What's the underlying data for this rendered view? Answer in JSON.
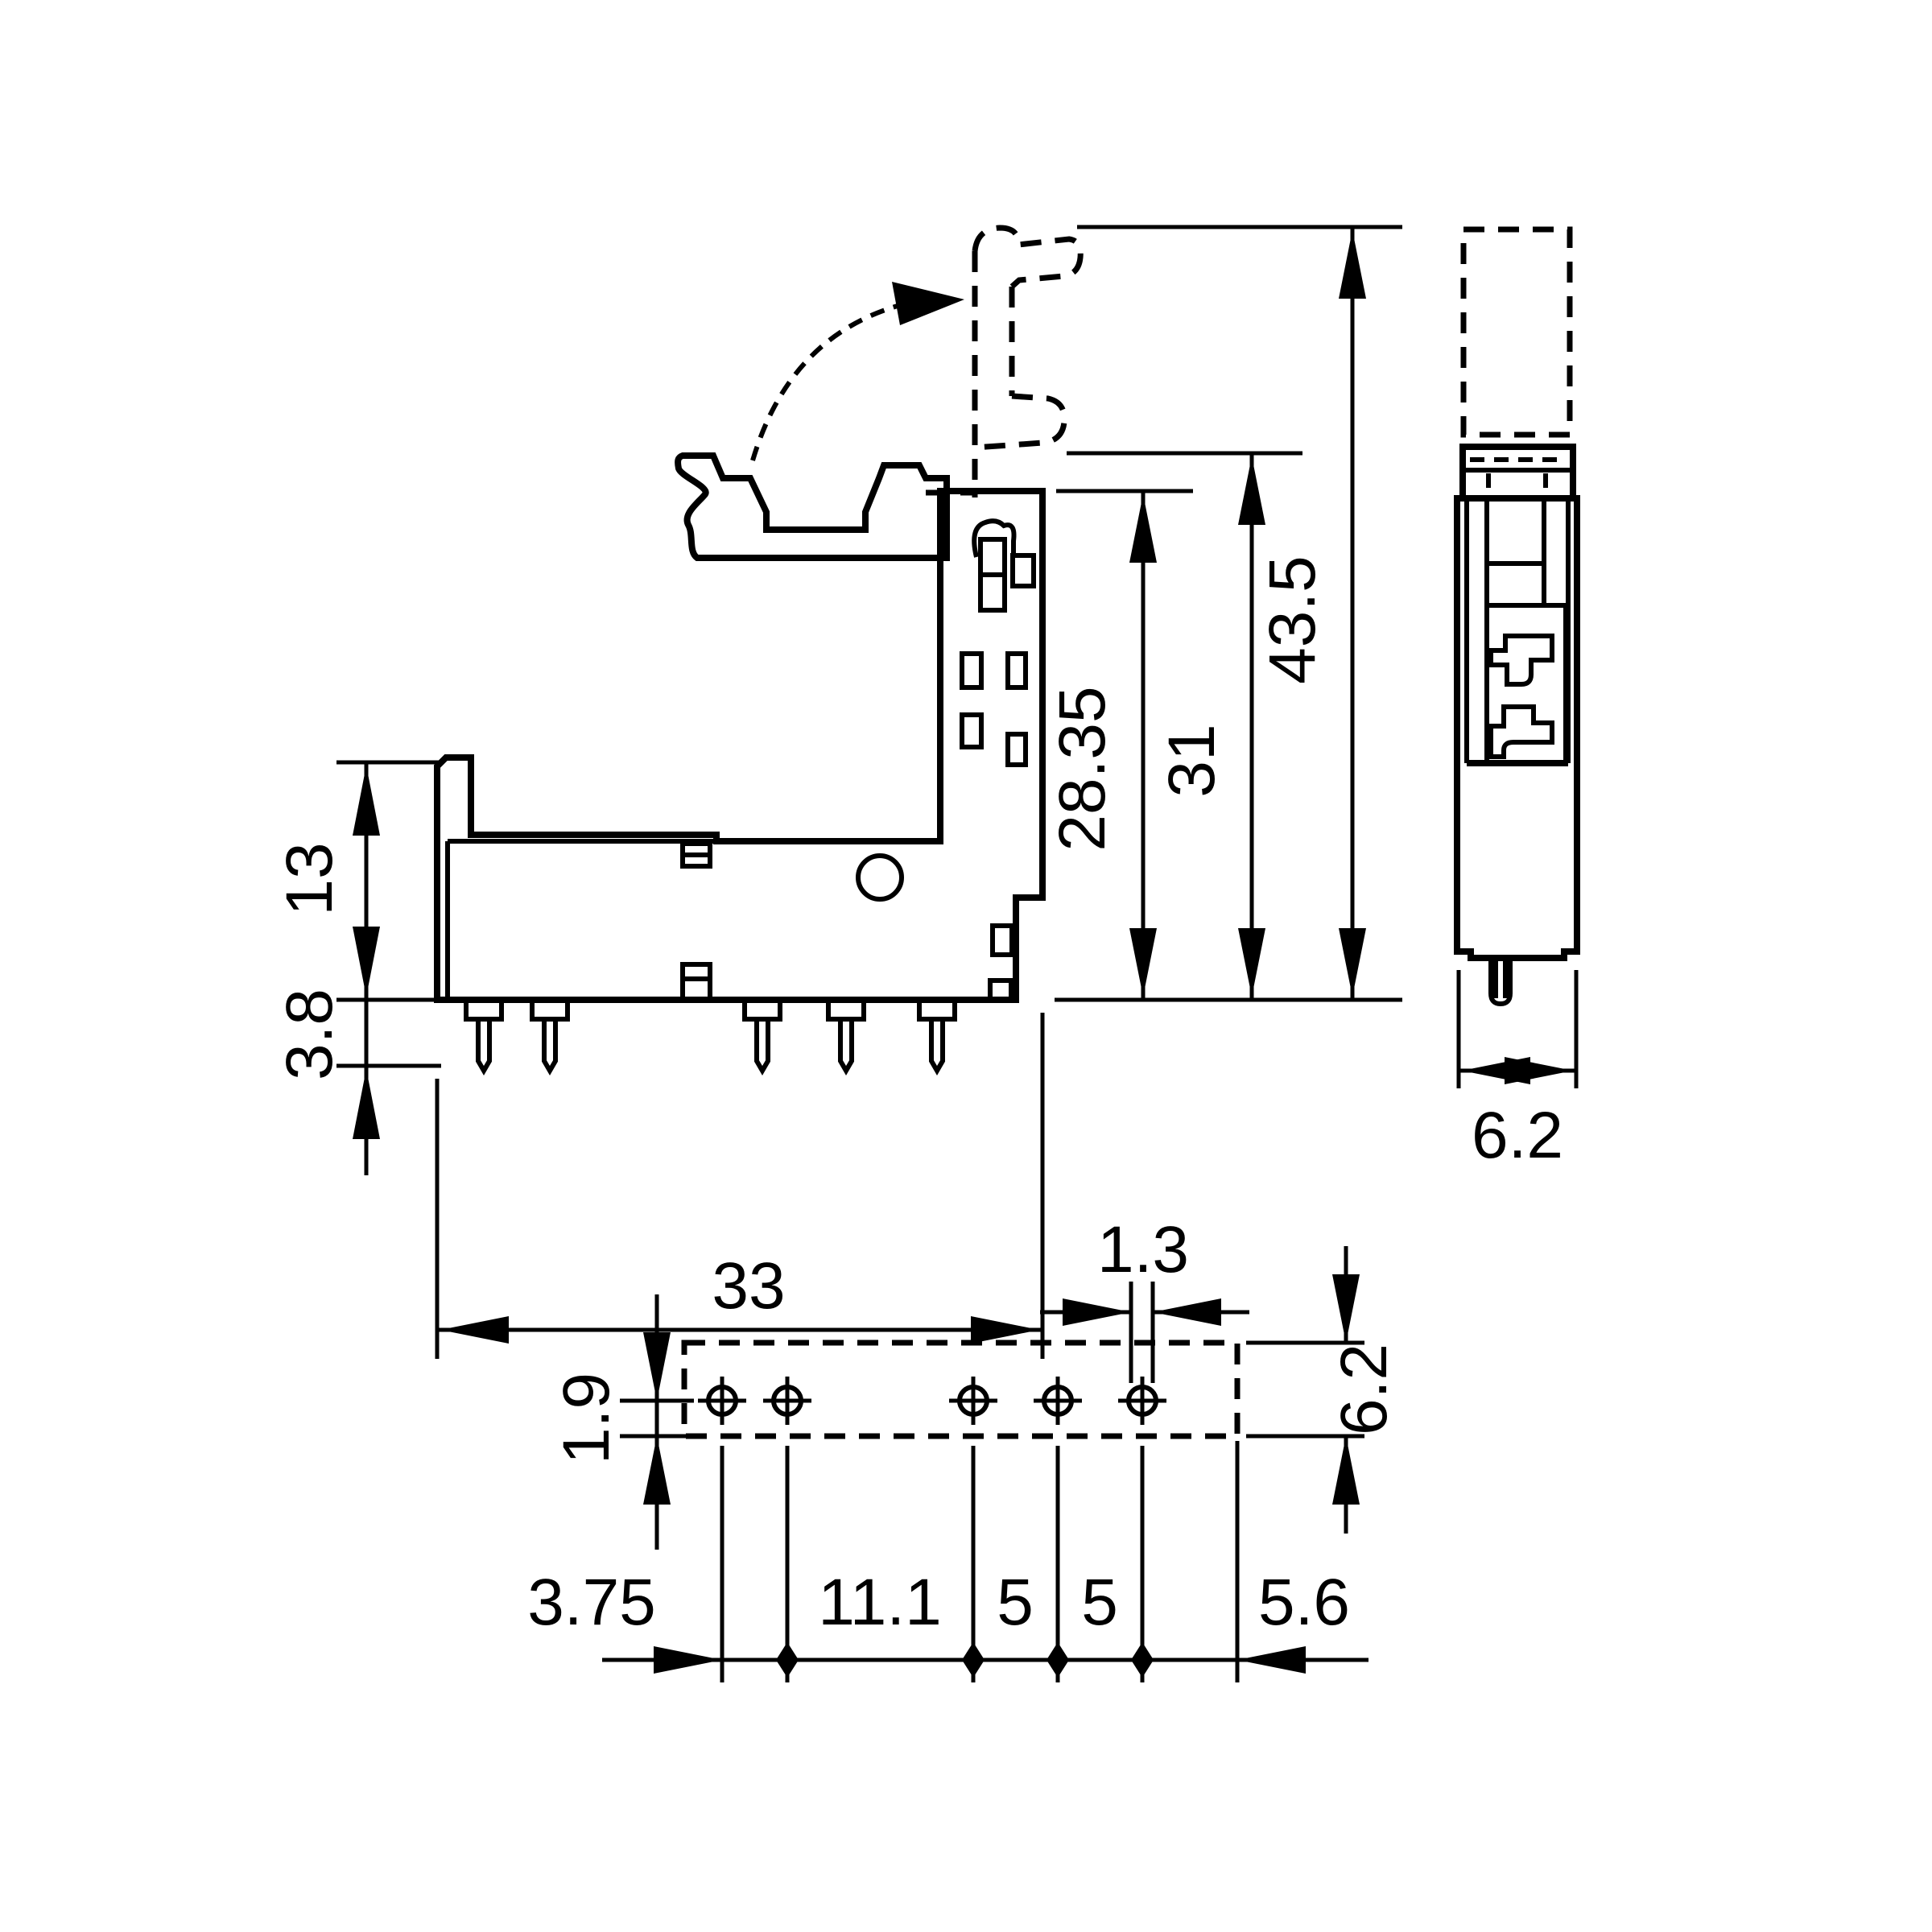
{
  "drawing": {
    "type": "technical-dimensional-drawing",
    "subject": "relay-socket",
    "units": "mm",
    "colors": {
      "ink": "#000000",
      "background": "#ffffff"
    },
    "front_view": {
      "dims": {
        "width": "33",
        "rail_height": "13",
        "pin_protrusion": "3.8",
        "body_height": "28.35",
        "release_height": "31",
        "total_height": "43.5"
      }
    },
    "side_view": {
      "dims": {
        "width": "6.2"
      }
    },
    "bottom_view": {
      "dims": {
        "pin_width": "1.3",
        "row_offset": "1.9",
        "row_depth": "6.2",
        "pitches": [
          "3.75",
          "11.1",
          "5",
          "5",
          "5.6"
        ]
      },
      "hole_count": 5
    }
  }
}
